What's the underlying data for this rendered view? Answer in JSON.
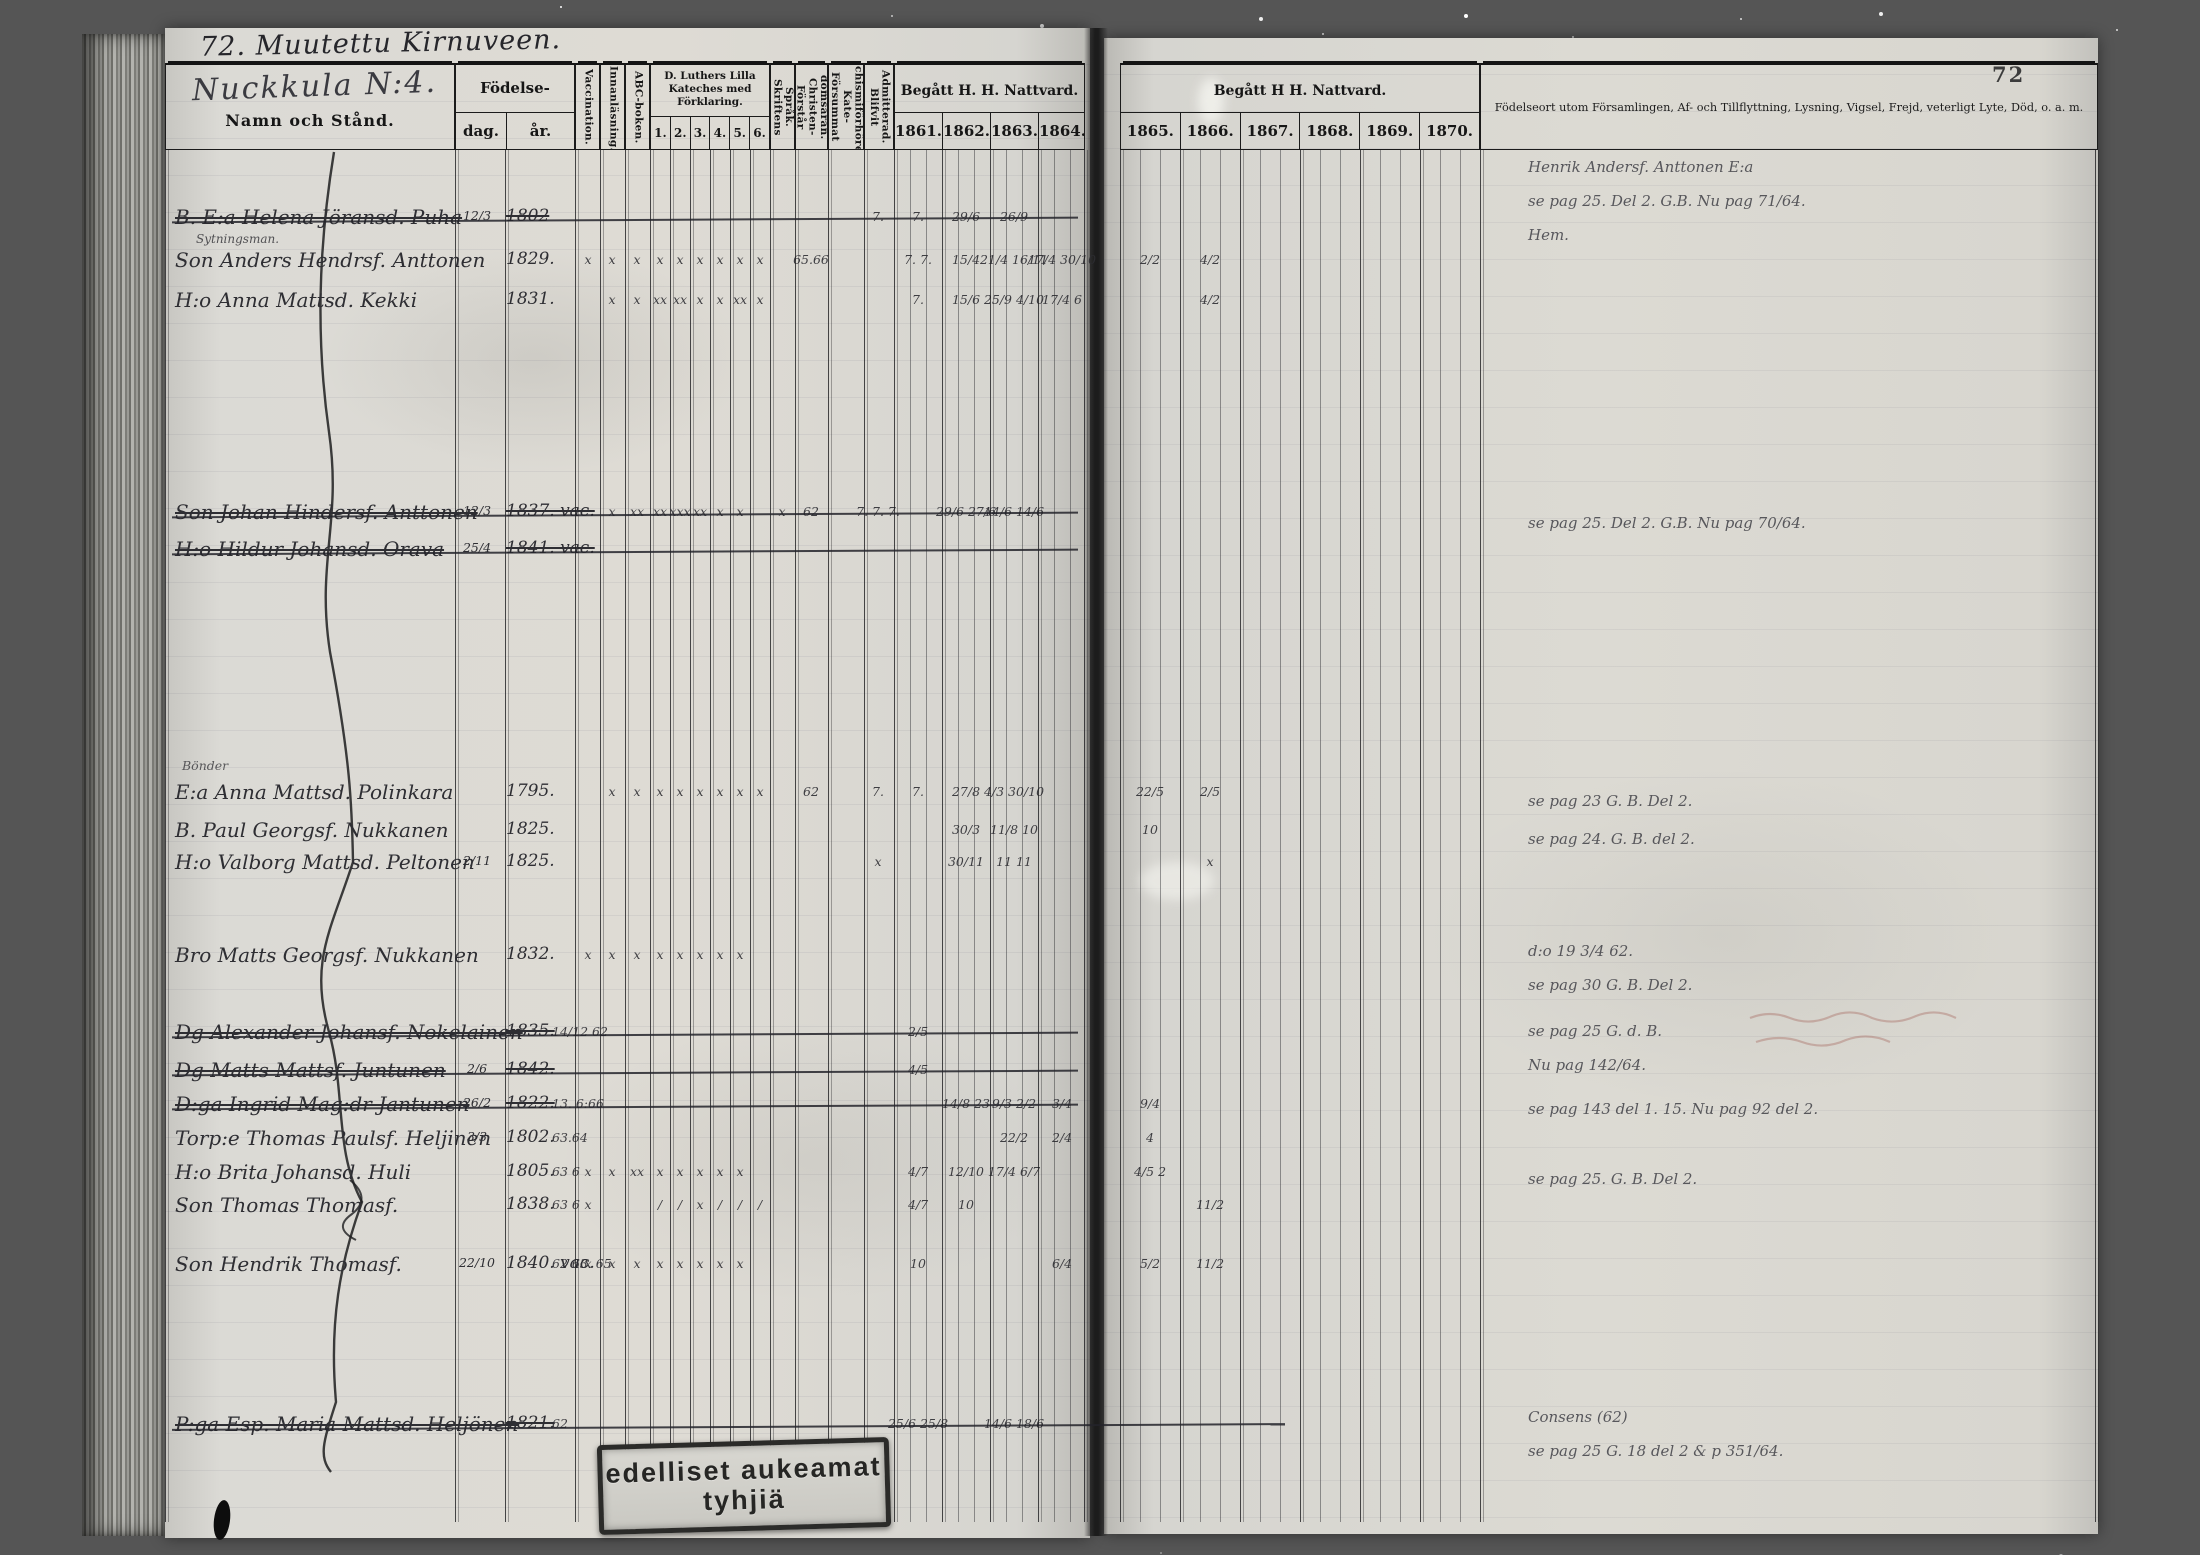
{
  "page": {
    "number": "72",
    "top_annotation": "72. Muutettu Kirnuveen.",
    "village_title": "Nuckkula N:4.",
    "stamp_line1": "edelliset aukeamat",
    "stamp_line2": "tyhjiä"
  },
  "colors": {
    "page": "#d9d8d2",
    "ink": "#2e2e33",
    "print": "#161616",
    "background": "#6f6f6d"
  },
  "table": {
    "headers": {
      "name": "Namn och Stånd.",
      "birth": "Födelse-",
      "birth_day": "dag.",
      "birth_year": "år.",
      "vaccination": "Vaccination.",
      "innanlasning": "Innanläsning.",
      "abc": "ABC-boken.",
      "katekes": "D. Luthers Lilla Kateches med Förklaring.",
      "katekes_cols": [
        "1.",
        "2.",
        "3.",
        "4.",
        "5.",
        "6."
      ],
      "skriftens": "Skriftens Språk.",
      "forstar": "Förstår Christen-domsäran.",
      "forsummat": "Försummat Kate-chismiförhören.",
      "admitterad": "Blifvit Admitterad.",
      "nattvard_left": "Begått H. H. Nattvard.",
      "nattvard_right": "Begått H  H. Nattvard.",
      "years_left": [
        "1861.",
        "1862.",
        "1863.",
        "1864."
      ],
      "years_right": [
        "1865.",
        "1866.",
        "1867.",
        "1868.",
        "1869.",
        "1870."
      ],
      "remarks": "Födelseort utom Församlingen, Af- och Tillflyttning, Lysning, Vigsel, Frejd, veterligt Lyte, Död, o. a. m."
    },
    "section_labels": [
      {
        "y": 758,
        "text": "Bönder"
      }
    ],
    "rows": [
      {
        "y": 205,
        "struck": true,
        "name": "B. E:a Helena Jöransd. Puha",
        "sub": "Sytningsman.",
        "day": "12/3",
        "year": "1802",
        "marks": {
          "adm": "7.",
          "y1861": "7.",
          "y1862": "29/6",
          "y1863": "26/9"
        }
      },
      {
        "y": 248,
        "struck": false,
        "name": "Son Anders Hendrsf. Anttonen",
        "year": "1829.",
        "marks": {
          "vacc": "x",
          "innan": "x",
          "abc": "x",
          "k1": "x",
          "k2": "x",
          "k3": "x",
          "k4": "x",
          "k5": "x",
          "k6": "x",
          "chr": "65.66",
          "y1861": "7. 7.",
          "y1862": "15/4",
          "y1863": "21/4 16/11",
          "y1864": "17/4 30/10",
          "y1865": "2/2",
          "y1866": "4/2"
        }
      },
      {
        "y": 288,
        "struck": false,
        "name": "H:o Anna Mattsd. Kekki",
        "year": "1831.",
        "marks": {
          "innan": "x",
          "abc": "x",
          "k1": "xx",
          "k2": "xx",
          "k3": "x",
          "k4": "x",
          "k5": "xx",
          "k6": "x",
          "y1861": "7.",
          "y1862": "15/6",
          "y1863": "25/9 4/10",
          "y1864": "17/4 6",
          "y1866": "4/2"
        }
      },
      {
        "y": 500,
        "struck": true,
        "name": "Son Johan Hindersf. Anttonen",
        "day": "12/3",
        "year": "1837. vac.",
        "marks": {
          "innan": "x",
          "abc": "xx",
          "k1": "xx",
          "k2": "xxx",
          "k3": "xx",
          "k4": "x",
          "k5": "x",
          "skrift": "x",
          "chr": "62",
          "adm": "7. 7. 7.",
          "y1862": "29/6 27/6",
          "y1863": "14/6 14/6"
        }
      },
      {
        "y": 537,
        "struck": true,
        "name": "H:o Hildur Johansd. Orava",
        "day": "25/4",
        "year": "1841. vac.",
        "marks": {}
      },
      {
        "y": 780,
        "struck": false,
        "name": "E:a Anna Mattsd. Polinkara",
        "year": "1795.",
        "marks": {
          "innan": "x",
          "abc": "x",
          "k1": "x",
          "k2": "x",
          "k3": "x",
          "k4": "x",
          "k5": "x",
          "k6": "x",
          "chr": "62",
          "adm": "7.",
          "y1861": "7.",
          "y1862": "27/8",
          "y1863": "4/3 30/10",
          "y1865": "22/5",
          "y1866": "2/5"
        }
      },
      {
        "y": 818,
        "struck": false,
        "name": "B. Paul Georgsf. Nukkanen",
        "year": "1825.",
        "marks": {
          "y1862": "30/3",
          "y1863": "11/8 10",
          "y1865": "10"
        }
      },
      {
        "y": 850,
        "struck": false,
        "name": "H:o Valborg Mattsd. Peltonen",
        "day": "2/11",
        "year": "1825.",
        "marks": {
          "adm": "x",
          "y1862": "30/11",
          "y1863": "11 11",
          "y1866": "x"
        }
      },
      {
        "y": 943,
        "struck": false,
        "name": "Bro Matts Georgsf. Nukkanen",
        "year": "1832.",
        "marks": {
          "vacc": "x",
          "innan": "x",
          "abc": "x",
          "k1": "x",
          "k2": "x",
          "k3": "x",
          "k4": "x",
          "k5": "x"
        }
      },
      {
        "y": 1020,
        "struck": true,
        "name": "Dg Alexander Johansf. Nokelainen",
        "year": "1835.",
        "marks": {
          "mid": "14/12 62",
          "y1861": "2/5"
        }
      },
      {
        "y": 1058,
        "struck": true,
        "name": "Dg Matts Mattsf. Juntunen",
        "day": "2/6",
        "year": "1842.",
        "marks": {
          "y1861": "4/5"
        }
      },
      {
        "y": 1092,
        "struck": true,
        "name": "D:ga Ingrid Mag:dr Jantunen",
        "day": "26/2",
        "year": "1822.",
        "marks": {
          "mid": "13. 6:66",
          "y1862": "14/8 23",
          "y1863": "9/3 2/2",
          "y1864": "3/4",
          "y1865": "9/4"
        }
      },
      {
        "y": 1126,
        "struck": false,
        "name": "Torp:e Thomas Paulsf. Heljinen",
        "day": "3/3",
        "year": "1802.",
        "marks": {
          "mid": "63.64",
          "y1863": "22/2",
          "y1864": "2/4",
          "y1865": "4"
        }
      },
      {
        "y": 1160,
        "struck": false,
        "name": "H:o Brita Johansd. Huli",
        "year": "1805.",
        "marks": {
          "vacc": "x",
          "innan": "x",
          "abc": "xx",
          "k1": "x",
          "k2": "x",
          "k3": "x",
          "k4": "x",
          "k5": "x",
          "mid": "63 6",
          "y1861": "4/7",
          "y1862": "12/10",
          "y1863": "17/4 6/7",
          "y1865": "4/5 2"
        }
      },
      {
        "y": 1193,
        "struck": false,
        "name": "Son Thomas Thomasf.",
        "year": "1838.",
        "marks": {
          "vacc": "x",
          "k1": "/",
          "k2": "/",
          "k3": "x",
          "k4": "/",
          "k5": "/",
          "k6": "/",
          "mid": "63 6",
          "y1861": "4/7",
          "y1862": "10",
          "y1866": "11/2"
        }
      },
      {
        "y": 1252,
        "struck": false,
        "name": "Son Hendrik Thomasf.",
        "day": "22/10",
        "year": "1840. vac.",
        "marks": {
          "vacc": "x",
          "innan": "x",
          "abc": "x",
          "k1": "x",
          "k2": "x",
          "k3": "x",
          "k4": "x",
          "k5": "x",
          "mid": "62 63. 65",
          "y1861": "10",
          "y1864": "6/4",
          "y1865": "5/2",
          "y1866": "11/2"
        }
      },
      {
        "y": 1412,
        "struck": true,
        "strike_to": 1285,
        "name": "P:ga Esp. Maria Mattsd. Heljönen",
        "year": "1821.",
        "marks": {
          "mid": "62",
          "y1861": "25/6 25/8",
          "y1863": "14/6 18/6"
        }
      }
    ],
    "remarks": [
      {
        "y": 150,
        "lines": [
          "Henrik Andersf. Anttonen E:a",
          "se pag 25. Del 2. G.B. Nu pag 71/64.",
          "Hem."
        ]
      },
      {
        "y": 506,
        "lines": [
          "se pag 25. Del 2. G.B. Nu pag 70/64."
        ]
      },
      {
        "y": 784,
        "lines": [
          "se pag 23 G. B. Del 2."
        ]
      },
      {
        "y": 822,
        "lines": [
          "se pag 24. G. B. del 2."
        ]
      },
      {
        "y": 934,
        "lines": [
          "d:o 19 3/4 62.",
          "se pag 30 G. B. Del 2."
        ]
      },
      {
        "y": 1014,
        "lines": [
          "se pag 25 G. d. B.",
          "Nu pag 142/64."
        ]
      },
      {
        "y": 1092,
        "lines": [
          "se pag 143 del 1. 15. Nu pag 92 del 2."
        ]
      },
      {
        "y": 1162,
        "lines": [
          "se pag 25. G. B. Del 2."
        ]
      },
      {
        "y": 1400,
        "lines": [
          "Consens (62)",
          "se pag 25 G. 18 del 2 & p 351/64."
        ]
      }
    ]
  }
}
